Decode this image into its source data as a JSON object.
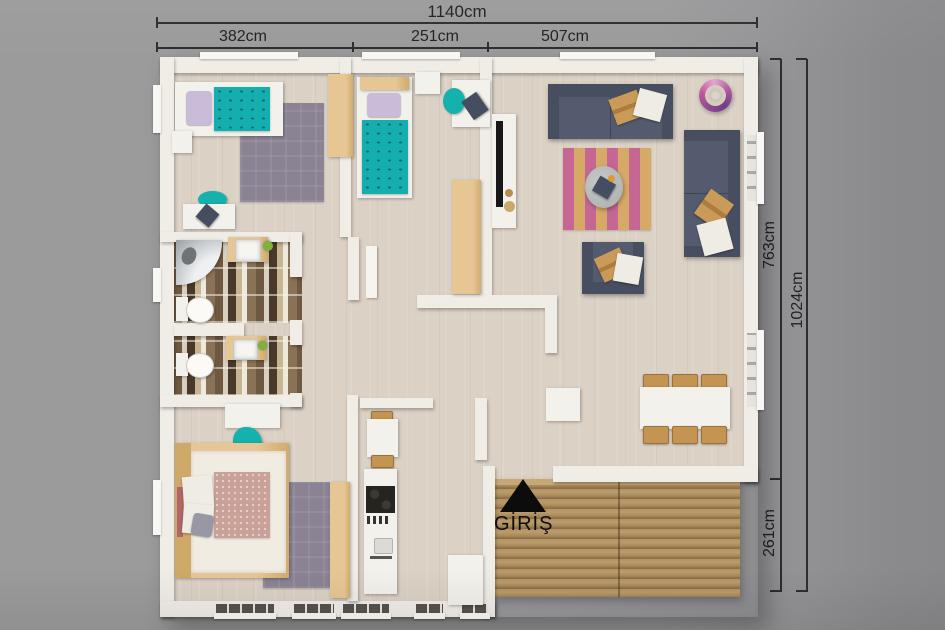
{
  "title": "house-floor-plan-top-view",
  "dimensions": {
    "top_total": "1140cm",
    "top_segments": [
      "382cm",
      "251cm",
      "507cm"
    ],
    "right_inner_top": "763cm",
    "right_inner_bottom": "261cm",
    "right_total": "1024cm",
    "unit": "cm"
  },
  "entrance": {
    "label": "GİRİŞ",
    "icon": "up-triangle-icon"
  },
  "colors": {
    "background_gray": "#9b9a9c",
    "wall_white": "#f0ede7",
    "floor_wood": "#dbd1c5",
    "deck_wood": "#a8895a",
    "accent_teal": "#15b1ac",
    "sofa_slate": "#545b6e",
    "furniture_tan": "#e0bf8d",
    "rug_purple": "#8b8394",
    "rug_stripe_pink": "#c4608f",
    "rug_stripe_yellow": "#d6a660",
    "pillow_lavender": "#c9bcd8",
    "bathroom_tile_brown": "#6e583f",
    "dimension_text": "#2e2e2e",
    "entrance_black": "#0c0c0c",
    "lamp_magenta": "#c3589c"
  }
}
